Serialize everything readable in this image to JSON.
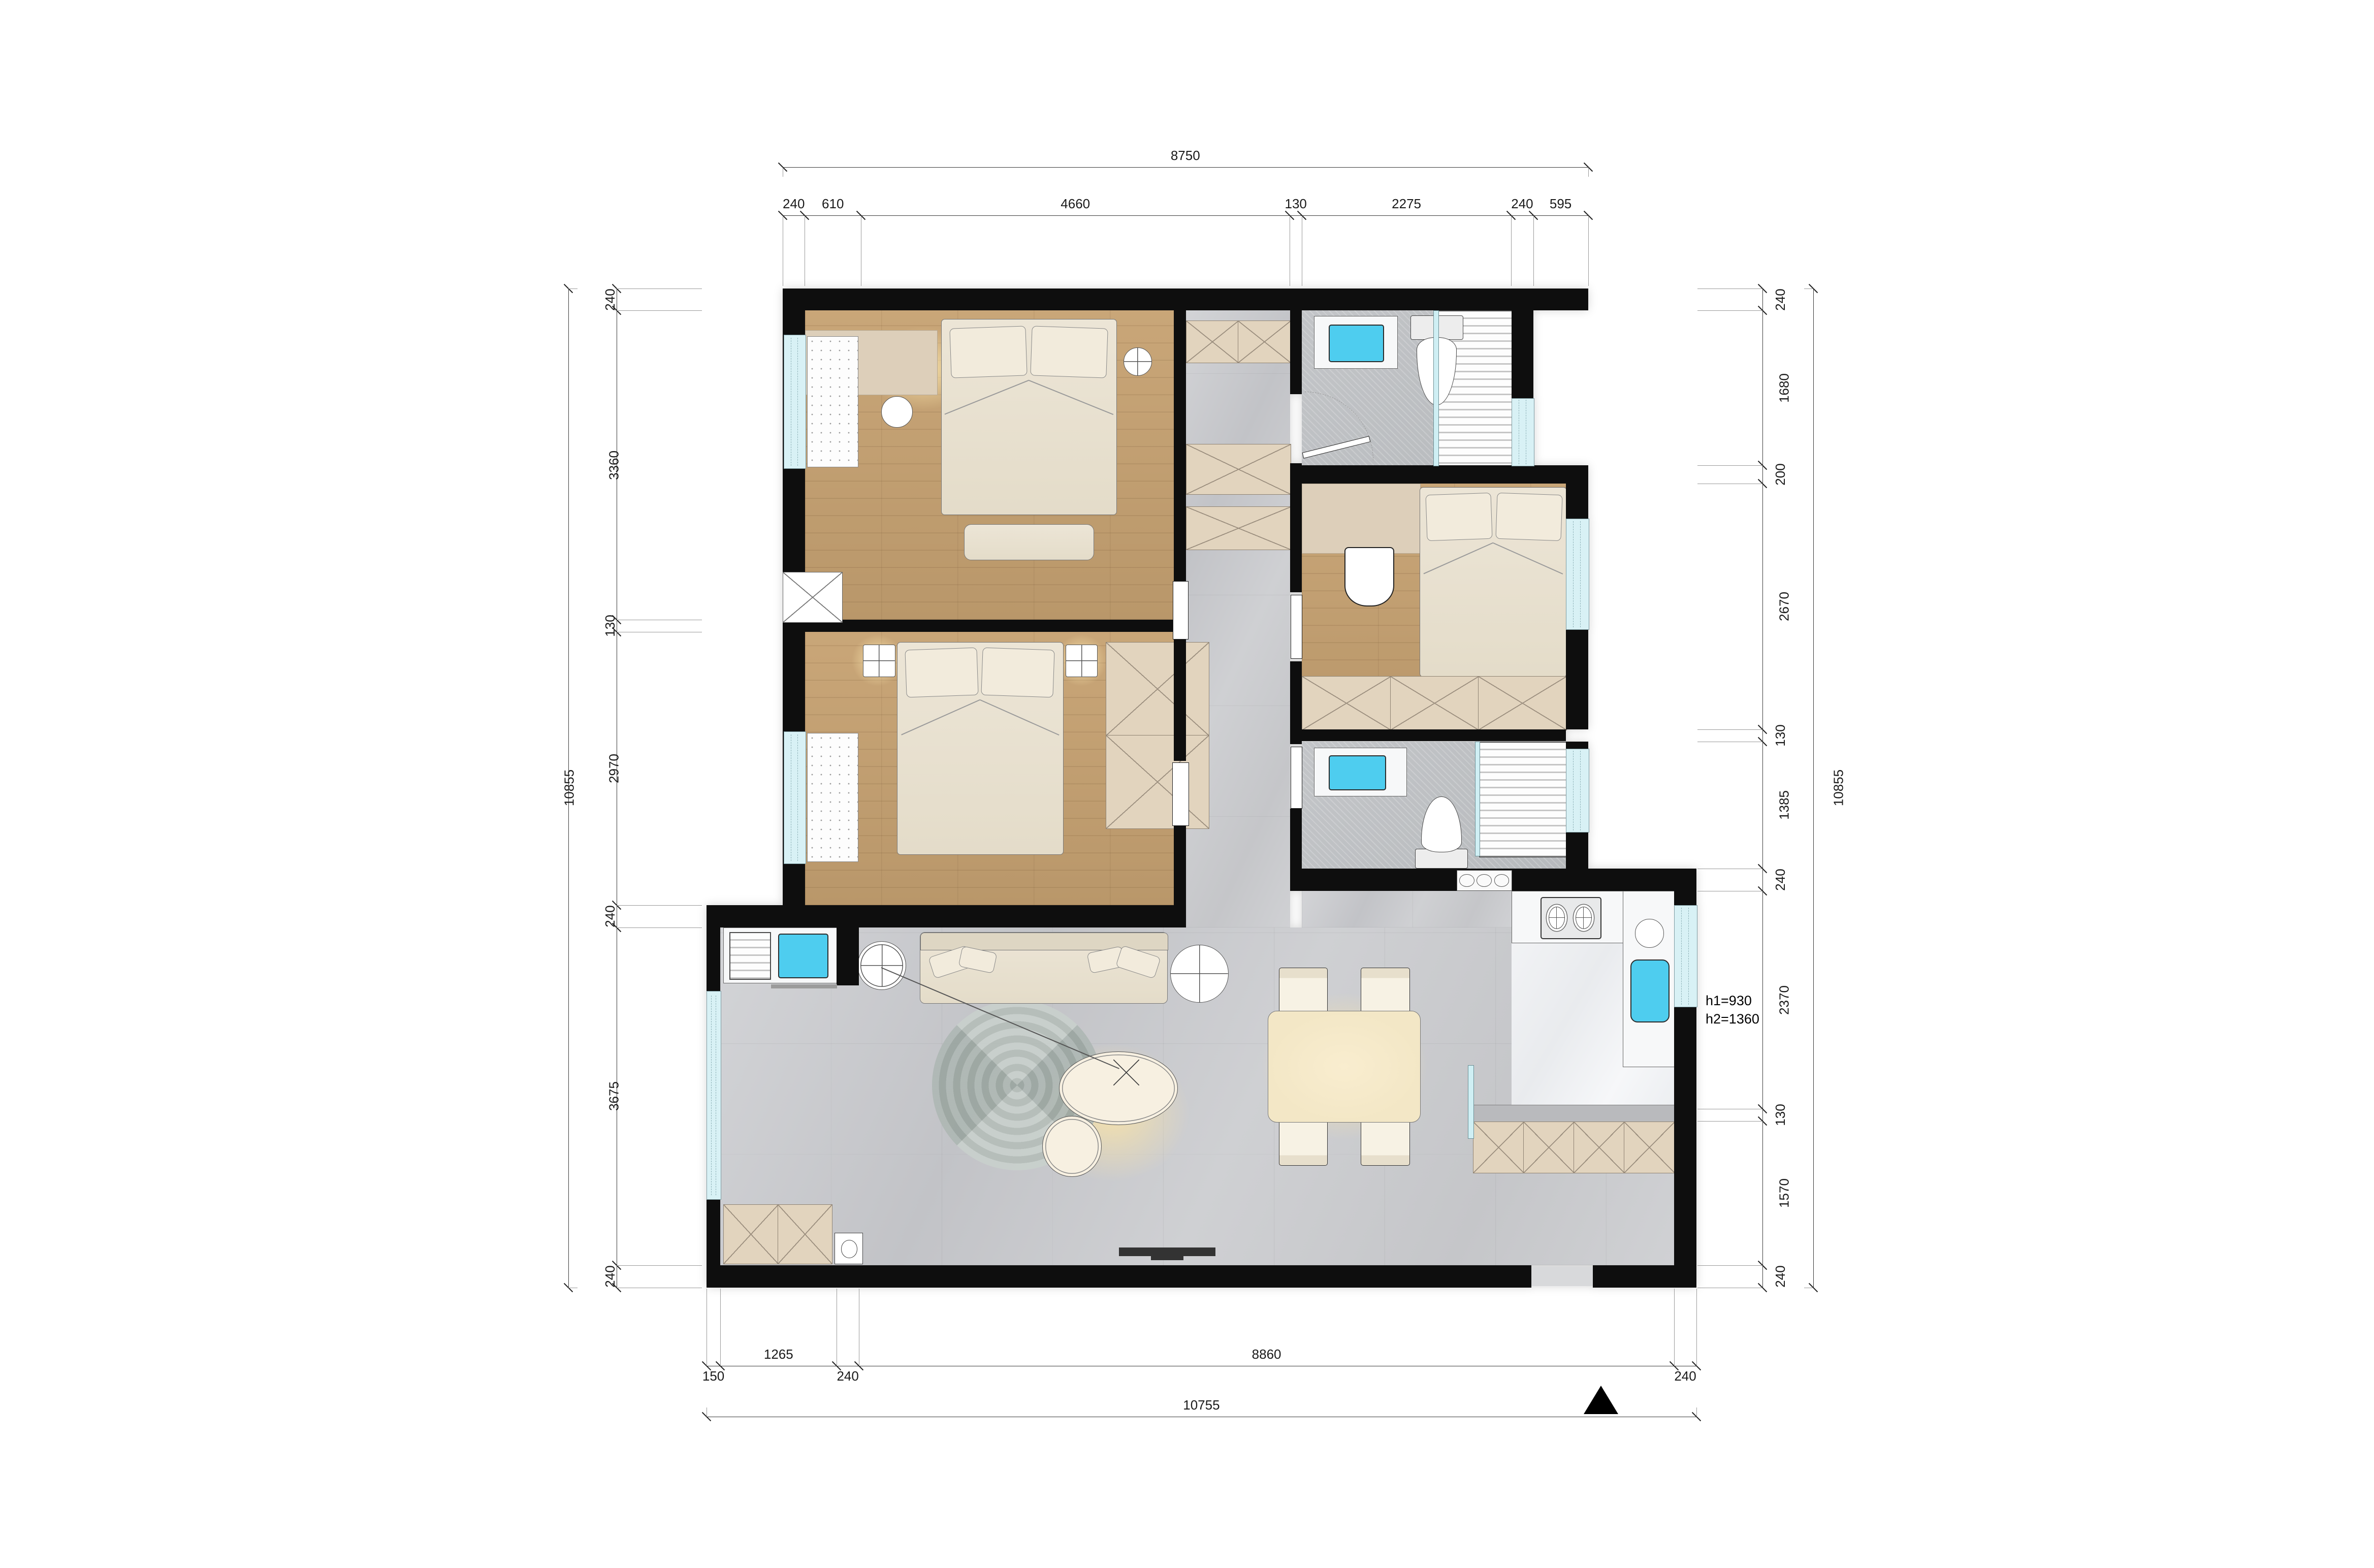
{
  "annotations": {
    "h1": "h1=930",
    "h2": "h2=1360"
  },
  "dimension_chains": [
    {
      "id": "top-overall",
      "segments": [
        8750
      ]
    },
    {
      "id": "top-detail",
      "segments": [
        240,
        610,
        4660,
        130,
        2275,
        240,
        595
      ]
    },
    {
      "id": "left-overall",
      "segments": [
        10855
      ]
    },
    {
      "id": "left-detail",
      "segments": [
        240,
        3360,
        130,
        2970,
        240,
        3675,
        240
      ]
    },
    {
      "id": "right-detail",
      "segments": [
        240,
        1680,
        200,
        2670,
        130,
        1385,
        240,
        2370,
        130,
        1570,
        240
      ]
    },
    {
      "id": "right-overall",
      "segments": [
        10855
      ]
    },
    {
      "id": "bottom-detail",
      "segments": [
        150,
        1265,
        240,
        8860,
        240
      ]
    },
    {
      "id": "bottom-overall",
      "segments": [
        10755
      ]
    }
  ],
  "colors": {
    "wall": "#0e0e0e",
    "window_glass": "#d8f1f5",
    "fixture_cyan": "#4ecdef",
    "wood_floor": "#c5a172",
    "tile_floor": "#cbccce",
    "cabinet_beige": "#e0d2bc",
    "counter_white": "#f4f5f6",
    "dim_text": "#1a1a1a"
  }
}
